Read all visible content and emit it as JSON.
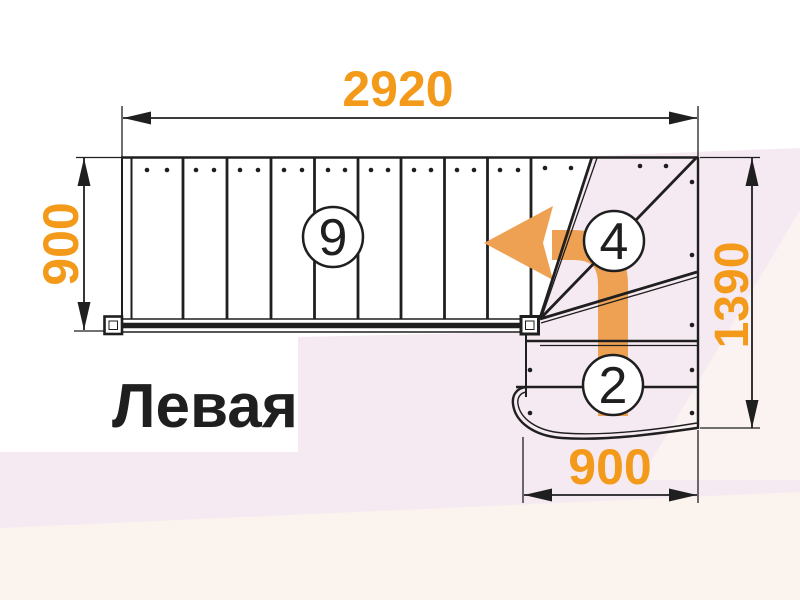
{
  "drawing": {
    "title": "Левая",
    "dimensions": {
      "top": "2920",
      "left": "900",
      "right": "1390",
      "bottom": "900"
    },
    "step_labels": {
      "straight_flight": "9",
      "winders": "4",
      "bottom_flight": "2"
    }
  },
  "colors": {
    "line": "#1f1f1f",
    "dim_text": "#f39a1a",
    "arrow": "#eea152",
    "bg_pink": "#f6eaf2",
    "bg_pink_light": "#fbf2f2",
    "bg_pink_bottom": "#faf3ee",
    "white": "#ffffff"
  }
}
